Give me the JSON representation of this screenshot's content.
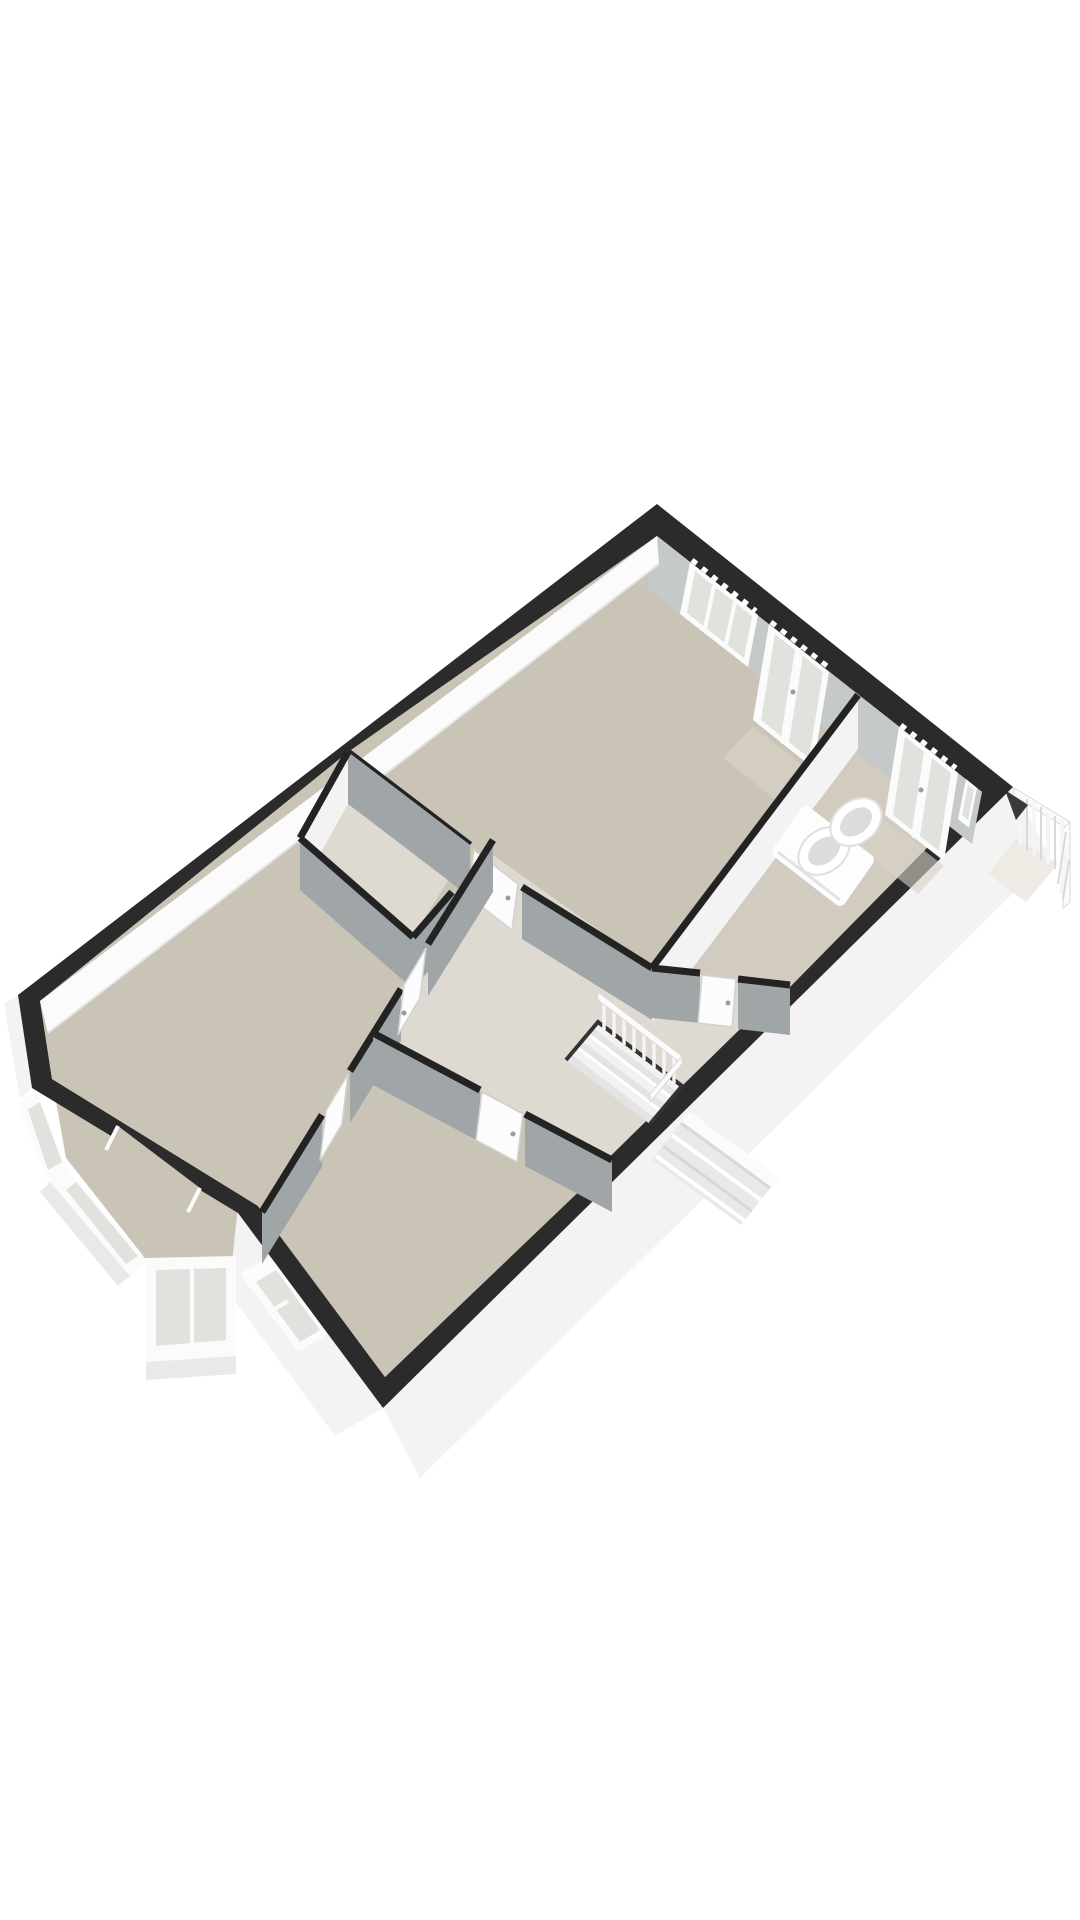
{
  "meta": {
    "kind": "3d-floor-plan-rendering",
    "view": "axonometric",
    "canvas_width": 1080,
    "canvas_height": 1920,
    "text_labels_visible": "none"
  },
  "colors": {
    "background": "#ffffff",
    "wall_cap": "#2b2b2b",
    "wall_cap_interior": "#232323",
    "exterior_face": "#f3f3f3",
    "exterior_face_shadow": "#e9e9e9",
    "ne_wall_face": "#c6c9ca",
    "nw_wall_face": "#fbfbfb",
    "wall_face_shadow": "#a0a5a7",
    "wall_face_mid": "#c3c6c7",
    "wall_face_light": "#f2f3f2",
    "floor_main": "#cac4b7",
    "floor_light": "#dedad2",
    "floor_bath": "#d2ccc0",
    "floor_patch": "#d8d2c6",
    "glass": "#dfe2dd",
    "frame_white": "#fbfbfb",
    "door_white": "#fcfcfc",
    "railing": "#f5f5f5",
    "stair_tread": "#f2f2f2",
    "stair_tread_dark": "#e4e4e4",
    "sink_basin": "#dcdcda",
    "vanity_white": "#fdfdfd"
  },
  "scene": {
    "rooms": [
      {
        "name": "bedroom-top",
        "floor": "beige",
        "features": [
          "wide-window",
          "glazed-double-doors"
        ]
      },
      {
        "name": "bathroom",
        "floor": "beige",
        "features": [
          "double-sink-vanity",
          "glazed-balcony-doors"
        ]
      },
      {
        "name": "living-room",
        "floor": "beige",
        "features": [
          "bay-window",
          "chamfered-corner"
        ]
      },
      {
        "name": "bedroom-bottom",
        "floor": "beige",
        "features": [
          "side-window"
        ]
      },
      {
        "name": "hallway",
        "floor": "light",
        "features": [
          "staircase",
          "interior-doors"
        ]
      },
      {
        "name": "storage-closet",
        "floor": "light",
        "features": []
      }
    ],
    "exterior_features": [
      {
        "name": "balcony-railing",
        "style": "white-vertical-balusters"
      },
      {
        "name": "exterior-steps",
        "style": "stepped-block-outside-se-wall"
      },
      {
        "name": "bay-window",
        "style": "angled-glass-bay"
      }
    ],
    "interior_features": [
      {
        "name": "staircase",
        "style": "open-stairwell-with-balustrade"
      },
      {
        "name": "vanity",
        "sinks": 2
      }
    ]
  }
}
